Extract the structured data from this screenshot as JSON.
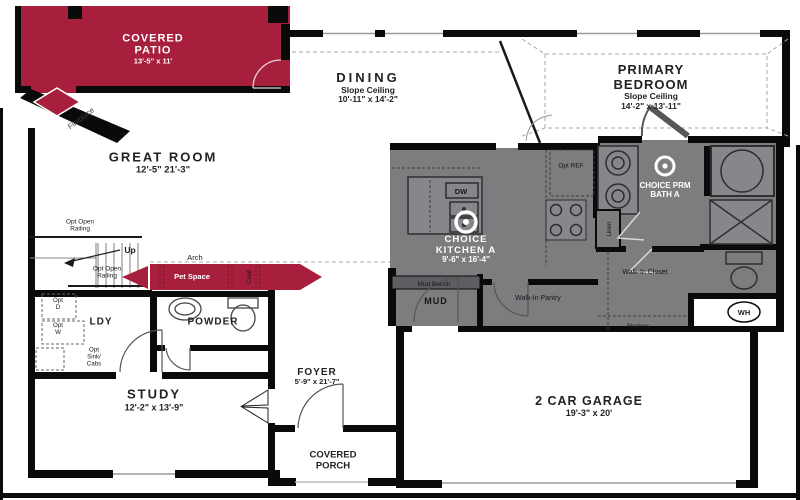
{
  "plan": {
    "colors": {
      "accent_red": "#a81f3e",
      "room_gray": "#7d7d80",
      "wall_black": "#0a0a0a"
    },
    "rooms": {
      "covered_patio": {
        "name": "COVERED PATIO",
        "dims": "13'-5\" x 11'"
      },
      "great_room": {
        "name": "GREAT ROOM",
        "dims": "12'-5\"  21'-3\""
      },
      "dining": {
        "name": "DINING",
        "note": "Slope Ceiling",
        "dims": "10'-11\" x 14'-2\""
      },
      "primary_bedroom": {
        "name": "PRIMARY BEDROOM",
        "note": "Slope Ceiling",
        "dims": "14'-2\" x 13'-11\""
      },
      "choice_kitchen": {
        "name": "CHOICE KITCHEN A",
        "dims": "9'-6\" x 16'-4\""
      },
      "choice_bath": {
        "name": "CHOICE PRM BATH A"
      },
      "study": {
        "name": "STUDY",
        "dims": "12'-2\" x 13'-9\""
      },
      "foyer": {
        "name": "FOYER",
        "dims": "5'-9\" x 21'-7\""
      },
      "covered_porch": {
        "name": "COVERED PORCH"
      },
      "garage": {
        "name": "2 CAR GARAGE",
        "dims": "19'-3\" x 20'"
      },
      "ldy": {
        "name": "LDY"
      },
      "powder": {
        "name": "POWDER"
      },
      "mud": {
        "name": "MUD"
      },
      "pantry": {
        "name": "Walk-In Pantry"
      },
      "closet": {
        "name": "Walk-In Closet"
      },
      "pet_space": {
        "name": "Pet Space"
      },
      "coat": {
        "name": "Coat"
      }
    },
    "labels": {
      "fireplace": "Fireplace",
      "railing_upper": "Opt Open Railing",
      "railing_lower": "Opt Open Railing",
      "up": "Up",
      "arch": "Arch",
      "opt_d": "Opt D",
      "opt_w": "Opt W",
      "opt_sink": "Opt Sink/ Cabs",
      "mud_bench": "Mud Bench",
      "dw": "DW",
      "opt_ref": "Opt REF",
      "linen": "Linen",
      "shelves": "Shelves",
      "wh": "WH"
    }
  }
}
